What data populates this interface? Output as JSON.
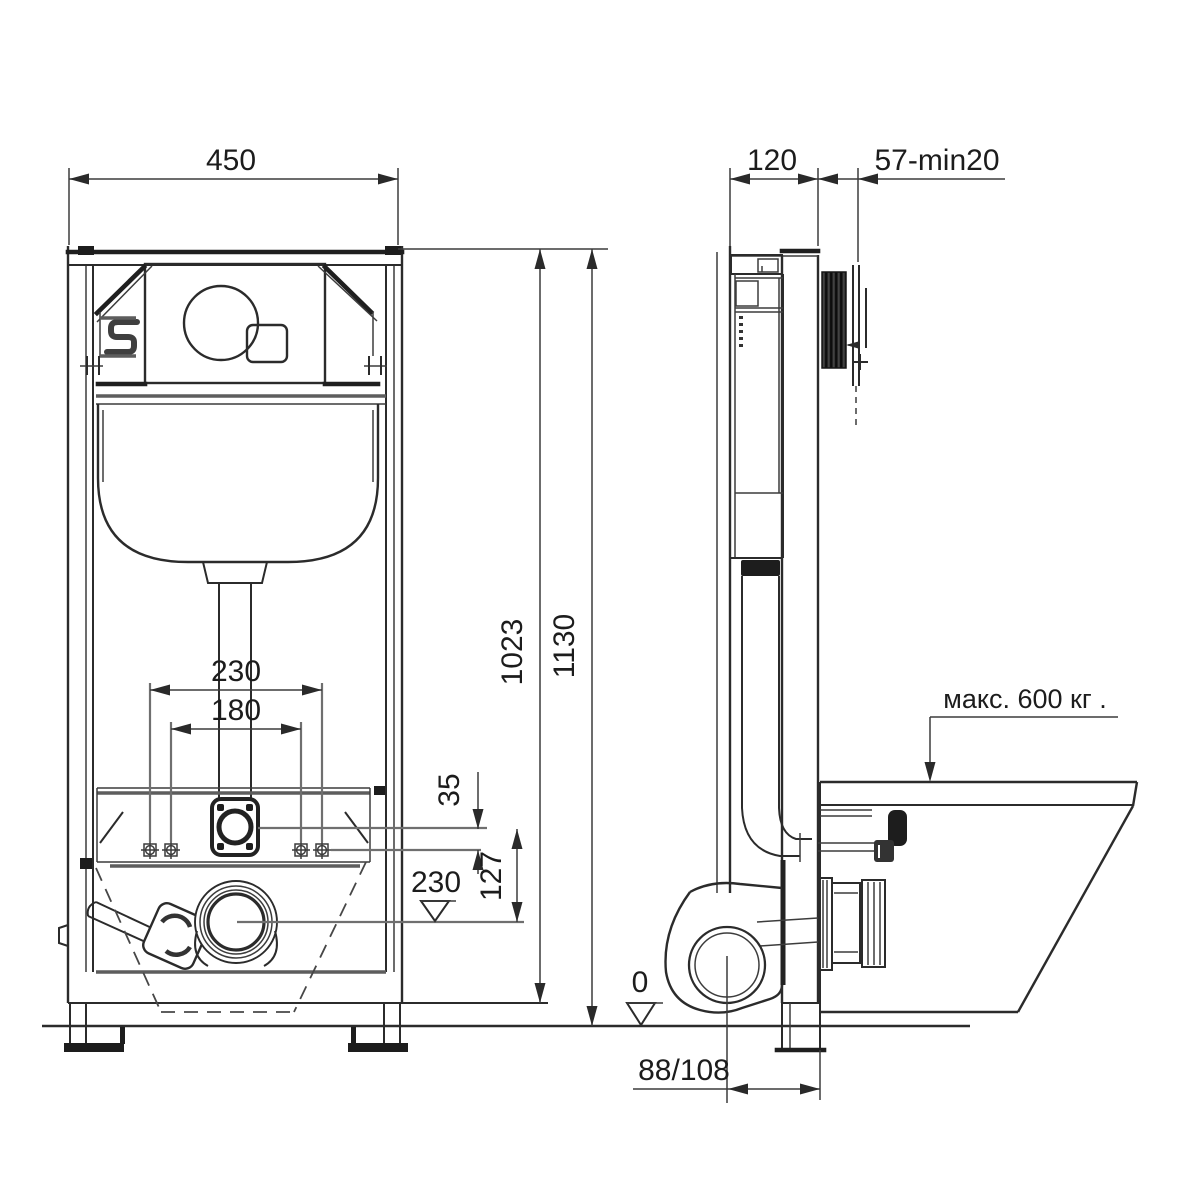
{
  "front_view": {
    "dim_width": "450",
    "dim_height_total": "1130",
    "dim_height_frame": "1023",
    "dim_fixing_spacing_outer": "230",
    "dim_fixing_spacing_inner": "180",
    "dim_inlet_below_plate": "35",
    "dim_inlet_to_drain": "127",
    "dim_drain_axis_level": "230"
  },
  "side_view": {
    "dim_depth": "120",
    "dim_actuator_distance": "57-min20",
    "max_load_note": "макс. 600 кг .",
    "zero_level": "0",
    "dim_drain_axis_offset": "88/108"
  }
}
